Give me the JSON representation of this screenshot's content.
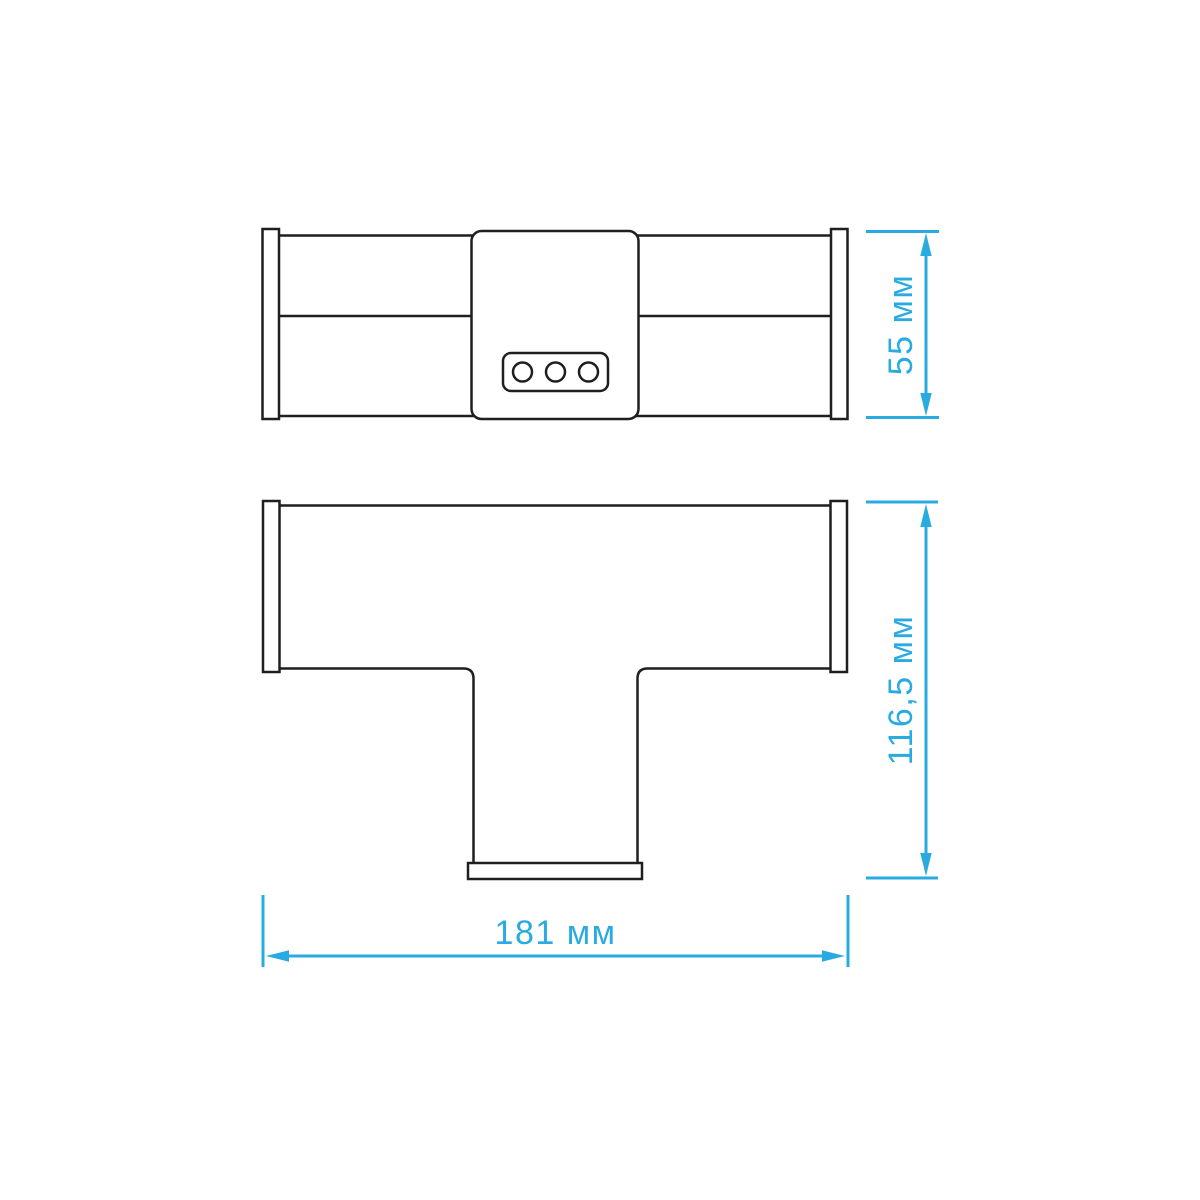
{
  "colors": {
    "accent": "#29ABE2",
    "outline": "#1F1F1F",
    "background": "#FFFFFF"
  },
  "dimensions": {
    "side_height": {
      "label": "55 мм",
      "value": "55",
      "unit": "мм",
      "orientation": "vertical"
    },
    "plan_depth": {
      "label": "116,5 мм",
      "value": "116,5",
      "unit": "мм",
      "orientation": "vertical"
    },
    "overall_width": {
      "label": "181 мм",
      "value": "181",
      "unit": "мм",
      "orientation": "horizontal"
    }
  }
}
